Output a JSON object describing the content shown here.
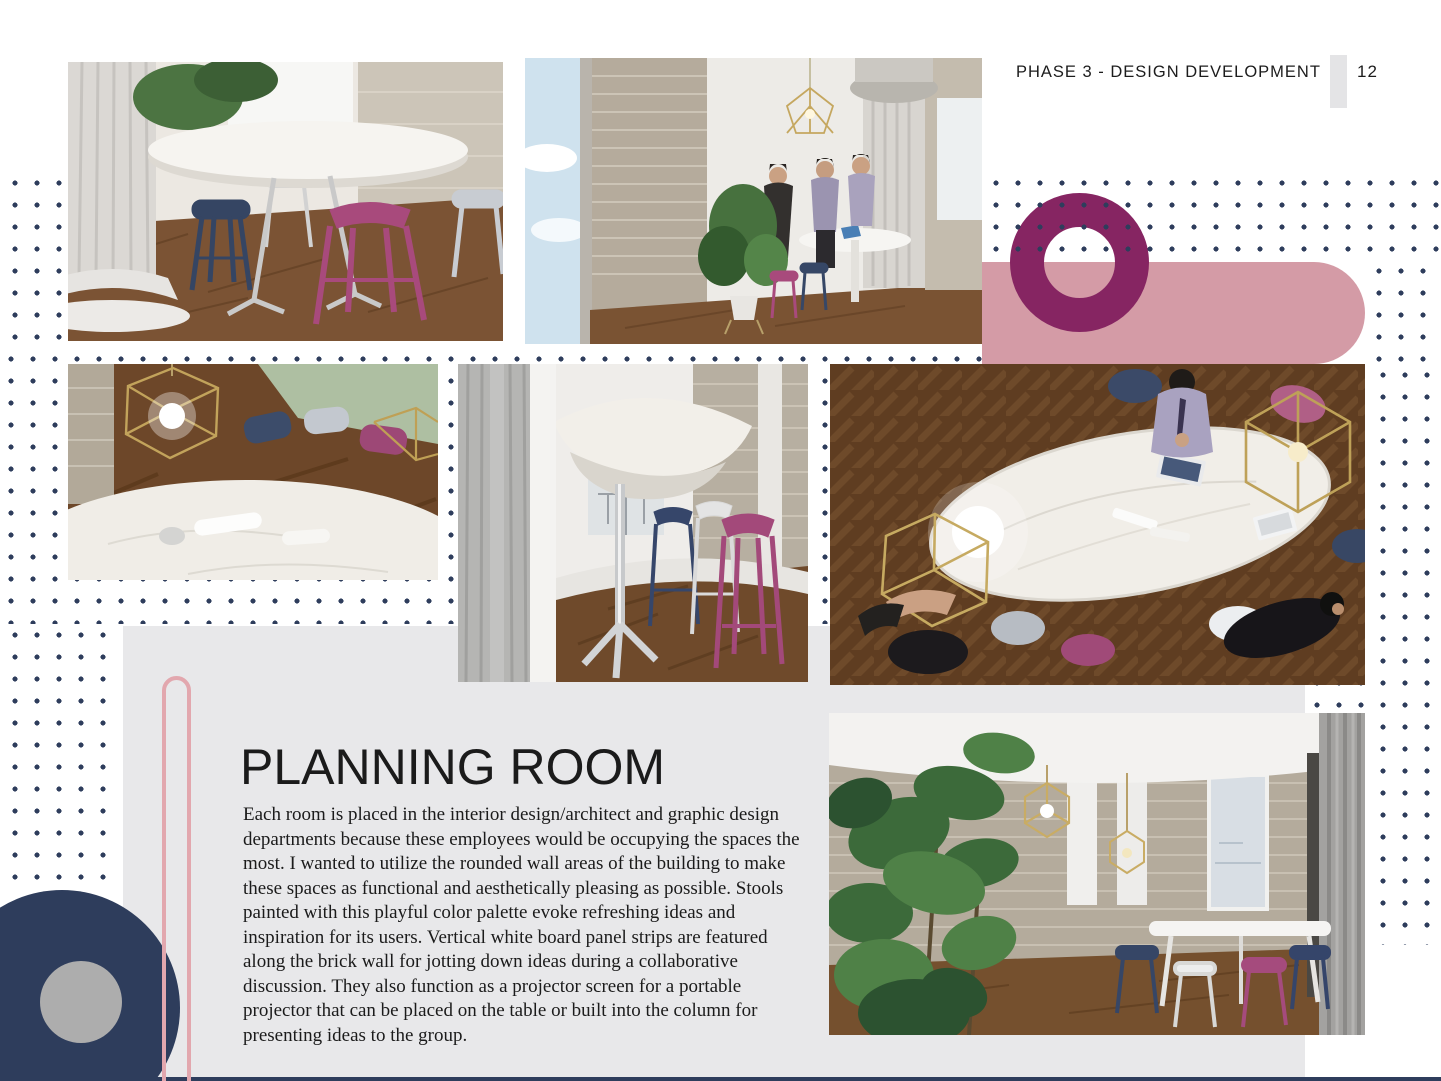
{
  "header": {
    "phase_label": "PHASE 3 - DESIGN DEVELOPMENT",
    "page_number": "12"
  },
  "content": {
    "title": "PLANNING ROOM",
    "paragraph": "Each room is placed in the interior design/architect and graphic design departments because these employees would be occupying the spaces the most. I wanted to utilize the rounded wall areas of the building to make these spaces as functional and aesthetically pleasing as possible. Stools painted with this playful color palette evoke refreshing ideas and inspiration for its users. Vertical white board panel strips are featured along the brick wall for jotting down ideas during a collaborative discussion. They also function as a projector screen for a portable projector that can be placed on the table or built into the column for presenting ideas to the group."
  },
  "images": {
    "stools_closeup": "Render of pink, navy and white bar stools around a white oval table on a wood floor beside a classical column",
    "meeting_corner": "Render of three people standing at a tall white table in a brick-walled corner with a fluted column and plant",
    "pendant_table_closeup": "Render close-up of brass geometric pendant lights glowing above a white marble table with colored stools",
    "column_stools_closeup": "Render close-up of a white pedestal table with magenta, white and navy bar stools against a brick wall",
    "table_top_view": "Render top view of an oval white marble table with laptops, geometric pendant lights, people and colored stools",
    "planning_room_plant": "Render of the planning room with a tall green plant, brick walls, white board strips, window and stools"
  },
  "colors": {
    "navy": "#2e3d5c",
    "pink": "#d49ba6",
    "plum": "#862562",
    "light_gray": "#e8e8ea",
    "capsule_pink": "#e2a7ae",
    "stool_magenta": "#a84a7c",
    "text": "#1b1b1b"
  }
}
